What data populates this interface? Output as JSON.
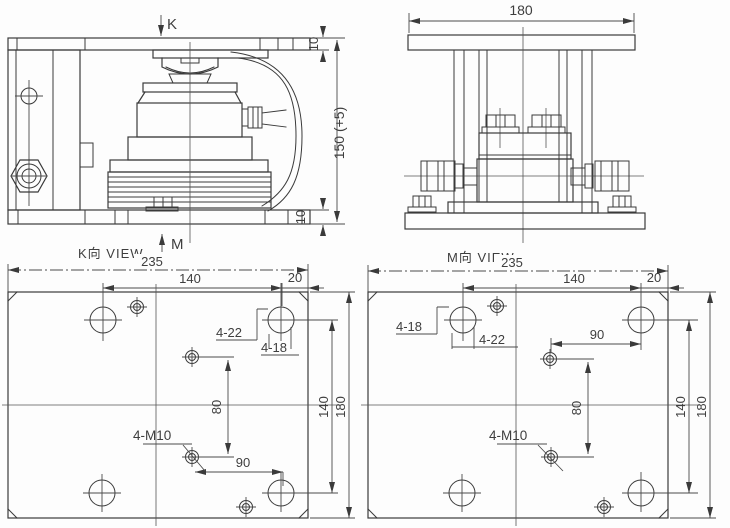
{
  "side_view": {
    "arrow_top_label": "K",
    "arrow_bottom_label": "M",
    "dim_top_plate_thickness": "10",
    "dim_bottom_plate_thickness": "10",
    "dim_overall_height": "150 (+5)"
  },
  "front_view": {
    "dim_overall_width": "180"
  },
  "k_view": {
    "caption": "K向 VIEW",
    "dim_overall_width": "235",
    "dim_hole_span_x": "140",
    "dim_edge_offset": "20",
    "label_large_holes": "4-22",
    "label_small_holes": "4-18",
    "dim_offset_y": "80",
    "dim_offset_x": "90",
    "label_tapped_holes": "4-M10",
    "dim_hole_span_y": "140",
    "dim_overall_height": "180"
  },
  "m_view": {
    "caption": "M向 VIEW",
    "dim_overall_width": "235",
    "dim_hole_span_x": "140",
    "dim_edge_offset": "20",
    "label_small_holes": "4-18",
    "label_large_holes": "4-22",
    "dim_offset_x": "90",
    "dim_offset_y": "80",
    "label_tapped_holes": "4-M10",
    "dim_hole_span_y": "140",
    "dim_overall_height": "180"
  }
}
